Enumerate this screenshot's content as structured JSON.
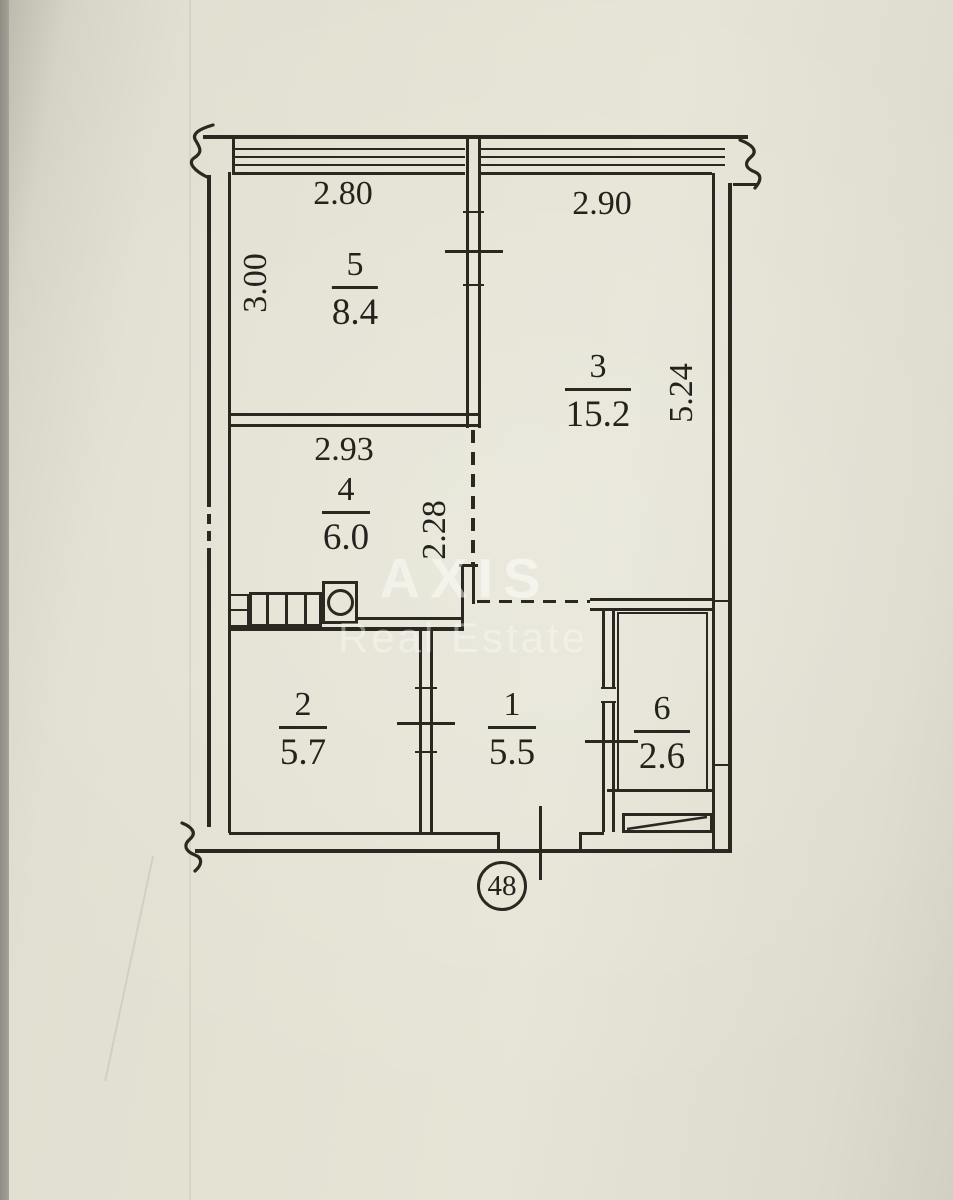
{
  "document": {
    "kind": "apartment floor plan photo",
    "apartment_number": "48",
    "watermark": {
      "line1": "AXIS",
      "line2": "Real Estate"
    },
    "rooms": [
      {
        "number": "5",
        "area": "8.4"
      },
      {
        "number": "3",
        "area": "15.2"
      },
      {
        "number": "4",
        "area": "6.0"
      },
      {
        "number": "2",
        "area": "5.7"
      },
      {
        "number": "1",
        "area": "5.5"
      },
      {
        "number": "6",
        "area": "2.6"
      }
    ],
    "dimensions": {
      "top_left": "2.80",
      "top_right": "2.90",
      "left_side": "3.00",
      "right_side": "5.24",
      "middle": "2.93",
      "middle_vertical": "2.28"
    },
    "colors": {
      "paper": "#e4e2d3",
      "ink": "#2b2822",
      "watermark": "rgba(253,253,249,0.5)"
    }
  }
}
